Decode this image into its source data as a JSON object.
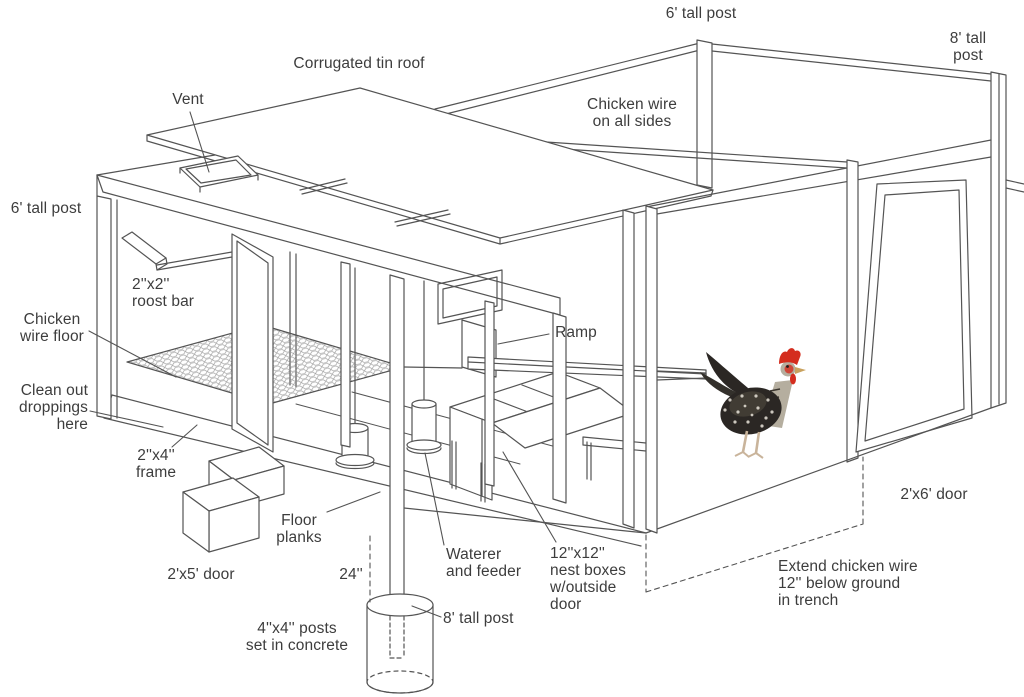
{
  "diagram": {
    "kind": "isometric line drawing",
    "subject_visible_text_only": true
  },
  "labels": {
    "post6_top": "6' tall post",
    "post8_top": "8' tall post",
    "roof": "Corrugated tin roof",
    "vent": "Vent",
    "wire_sides": "Chicken wire\non all sides",
    "post6_left": "6' tall post",
    "roost_bar": "2''x2''\nroost bar",
    "wire_floor": "Chicken\nwire floor",
    "clean_out": "Clean out\ndroppings\nhere",
    "frame_2x4": "2''x4''\nframe",
    "ramp": "Ramp",
    "floor_planks": "Floor\nplanks",
    "door_2x5": "2'x5' door",
    "dim_24": "24''",
    "waterer": "Waterer\nand feeder",
    "nest_boxes": "12''x12''\nnest boxes\nw/outside\ndoor",
    "post8_bottom": "8' tall post",
    "posts_concrete": "4''x4'' posts\nset in concrete",
    "door_2x6": "2'x6' door",
    "trench": "Extend chicken wire\n12'' below ground\nin trench"
  },
  "colors": {
    "line": "#545454",
    "text": "#3d3d3d",
    "background": "#ffffff",
    "chicken_body": "#2b2724",
    "chicken_comb": "#d42d1e",
    "chicken_legs": "#c9b49b"
  }
}
